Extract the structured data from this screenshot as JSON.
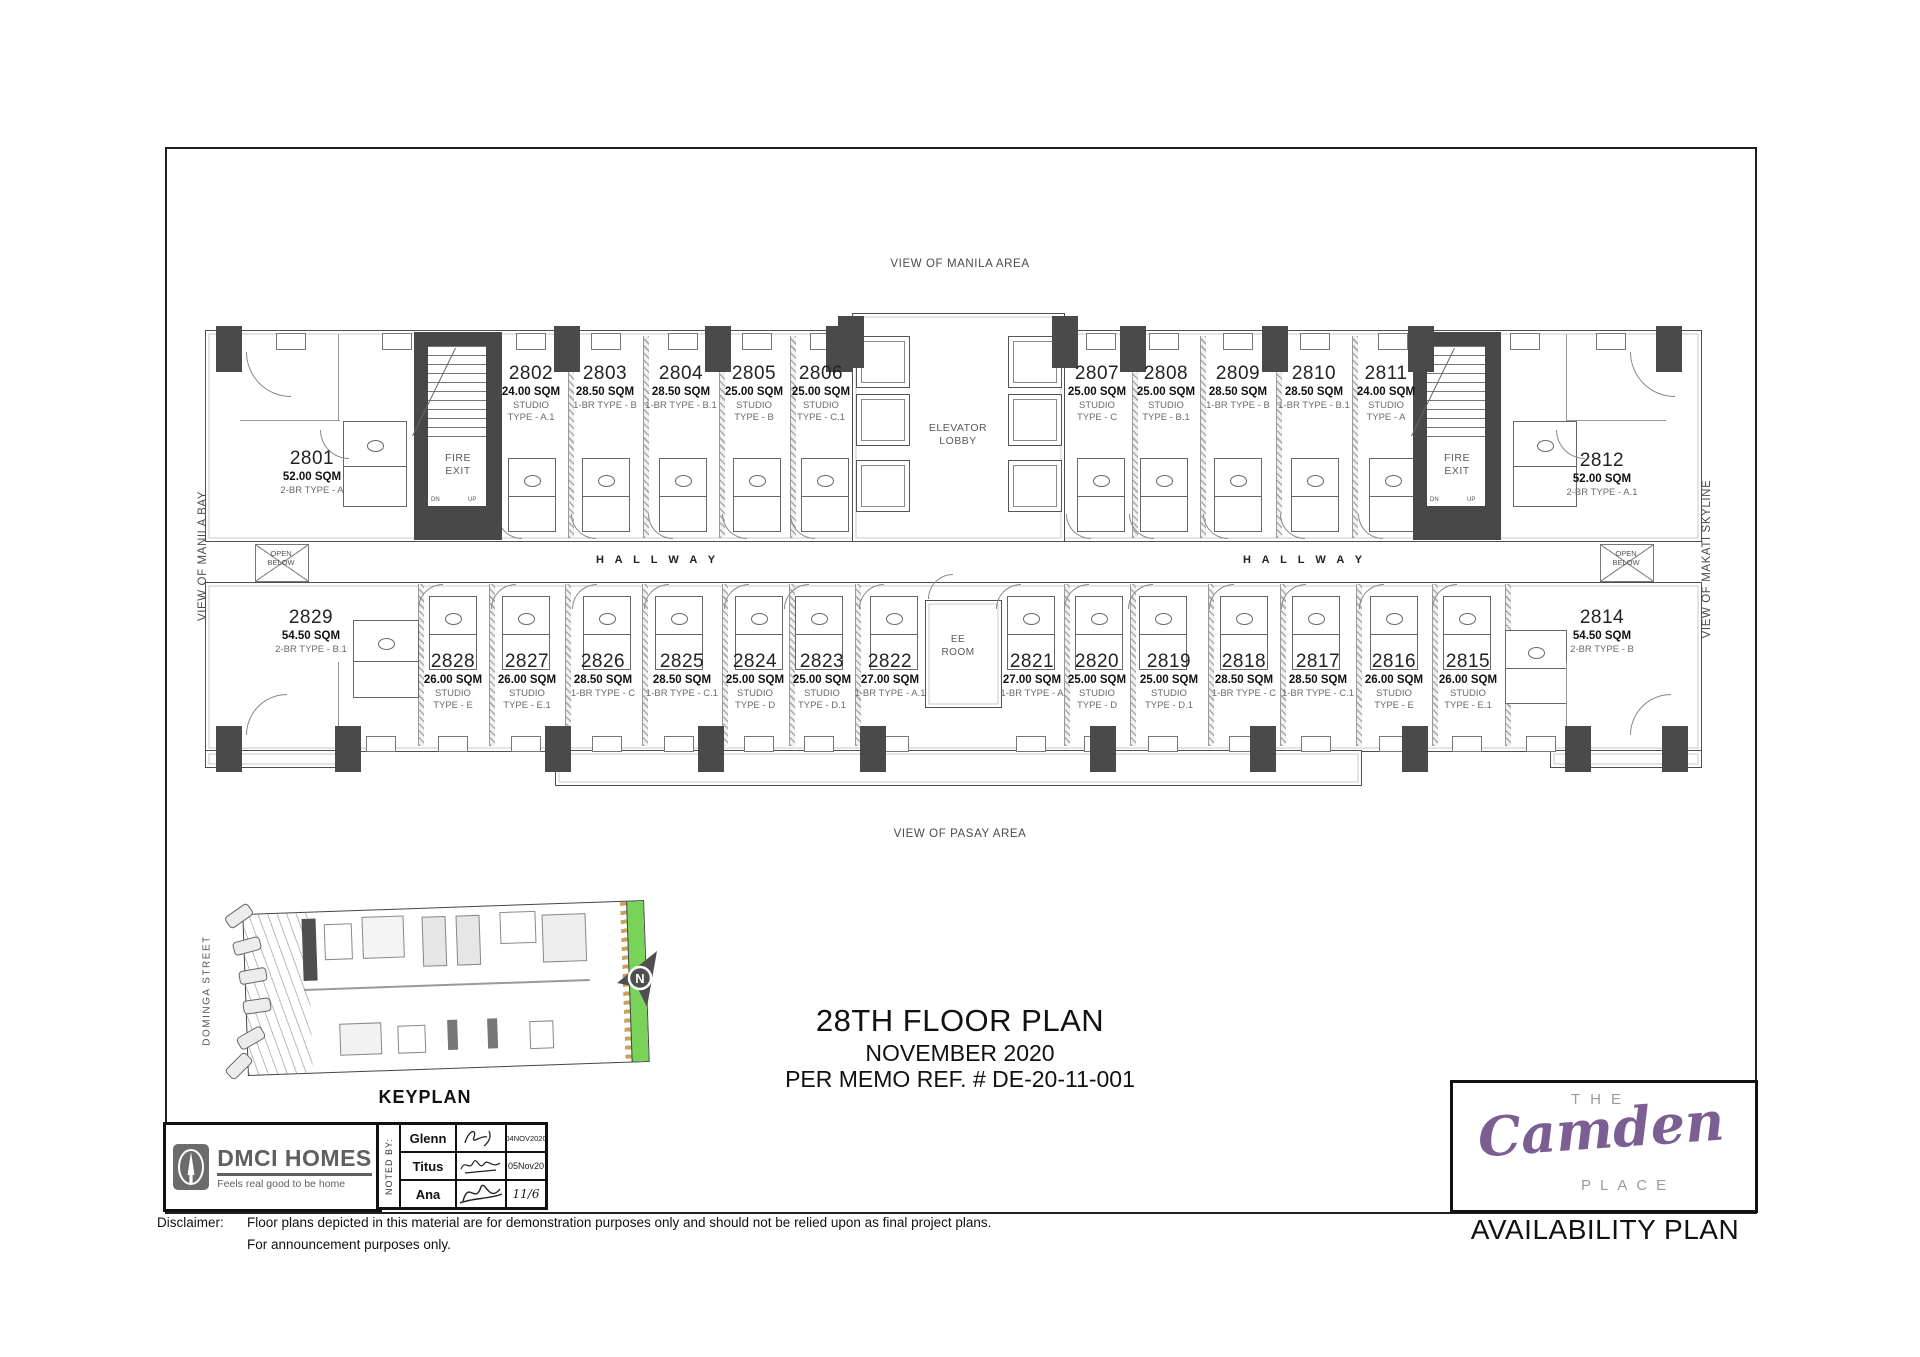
{
  "sheet": {
    "title": "28TH FLOOR PLAN",
    "subtitle": "NOVEMBER 2020",
    "memo": "PER MEMO REF. # DE-20-11-001",
    "availability": "AVAILABILITY PLAN"
  },
  "views": {
    "top": "VIEW OF MANILA AREA",
    "bottom": "VIEW OF PASAY AREA",
    "left": "VIEW OF MANILA BAY",
    "right": "VIEW OF MAKATI SKYLINE"
  },
  "plan_labels": {
    "elevator_lobby": "ELEVATOR\nLOBBY",
    "ee_room": "EE\nROOM",
    "fire_exit": "FIRE\nEXIT",
    "hallway": "H A L L W A Y",
    "open_below": "OPEN\nBELOW",
    "dn": "DN",
    "up": "UP"
  },
  "units_top": [
    {
      "number": "2801",
      "area": "52.00 SQM",
      "type": "2-BR TYPE - A"
    },
    {
      "number": "2802",
      "area": "24.00 SQM",
      "type": "STUDIO\nTYPE - A.1"
    },
    {
      "number": "2803",
      "area": "28.50 SQM",
      "type": "1-BR TYPE - B"
    },
    {
      "number": "2804",
      "area": "28.50 SQM",
      "type": "1-BR TYPE - B.1"
    },
    {
      "number": "2805",
      "area": "25.00 SQM",
      "type": "STUDIO\nTYPE - B"
    },
    {
      "number": "2806",
      "area": "25.00 SQM",
      "type": "STUDIO\nTYPE - C.1"
    },
    {
      "number": "2807",
      "area": "25.00 SQM",
      "type": "STUDIO\nTYPE - C"
    },
    {
      "number": "2808",
      "area": "25.00 SQM",
      "type": "STUDIO\nTYPE - B.1"
    },
    {
      "number": "2809",
      "area": "28.50 SQM",
      "type": "1-BR TYPE - B"
    },
    {
      "number": "2810",
      "area": "28.50 SQM",
      "type": "1-BR TYPE - B.1"
    },
    {
      "number": "2811",
      "area": "24.00 SQM",
      "type": "STUDIO\nTYPE - A"
    },
    {
      "number": "2812",
      "area": "52.00 SQM",
      "type": "2-BR TYPE - A.1"
    }
  ],
  "units_bottom": [
    {
      "number": "2829",
      "area": "54.50 SQM",
      "type": "2-BR TYPE - B.1"
    },
    {
      "number": "2828",
      "area": "26.00 SQM",
      "type": "STUDIO\nTYPE - E"
    },
    {
      "number": "2827",
      "area": "26.00 SQM",
      "type": "STUDIO\nTYPE - E.1"
    },
    {
      "number": "2826",
      "area": "28.50 SQM",
      "type": "1-BR TYPE - C"
    },
    {
      "number": "2825",
      "area": "28.50 SQM",
      "type": "1-BR TYPE - C.1"
    },
    {
      "number": "2824",
      "area": "25.00 SQM",
      "type": "STUDIO\nTYPE - D"
    },
    {
      "number": "2823",
      "area": "25.00 SQM",
      "type": "STUDIO\nTYPE - D.1"
    },
    {
      "number": "2822",
      "area": "27.00 SQM",
      "type": "1-BR TYPE - A.1"
    },
    {
      "number": "2821",
      "area": "27.00 SQM",
      "type": "1-BR TYPE - A"
    },
    {
      "number": "2820",
      "area": "25.00 SQM",
      "type": "STUDIO\nTYPE - D"
    },
    {
      "number": "2819",
      "area": "25.00 SQM",
      "type": "STUDIO\nTYPE - D.1"
    },
    {
      "number": "2818",
      "area": "28.50 SQM",
      "type": "1-BR TYPE - C"
    },
    {
      "number": "2817",
      "area": "28.50 SQM",
      "type": "1-BR TYPE - C.1"
    },
    {
      "number": "2816",
      "area": "26.00 SQM",
      "type": "STUDIO\nTYPE - E"
    },
    {
      "number": "2815",
      "area": "26.00 SQM",
      "type": "STUDIO\nTYPE - E.1"
    },
    {
      "number": "2814",
      "area": "54.50 SQM",
      "type": "2-BR TYPE - B"
    }
  ],
  "keyplan": {
    "caption": "KEYPLAN",
    "street": "DOMINGA STREET",
    "north": "N"
  },
  "branding": {
    "dmci_name": "DMCI HOMES",
    "dmci_tagline": "Feels real good to be home",
    "the": "THE",
    "camden": "Camden",
    "place": "PLACE"
  },
  "noted_by": {
    "label": "NOTED BY:",
    "rows": [
      {
        "name": "Glenn",
        "date": "04NOV2020"
      },
      {
        "name": "Titus",
        "date": "05Nov20"
      },
      {
        "name": "Ana",
        "date": "11/6"
      }
    ]
  },
  "disclaimer": {
    "label": "Disclaimer:",
    "line1": "Floor plans depicted in this material are for demonstration purposes only and should not be relied upon as final project plans.",
    "line2": "For announcement purposes only."
  },
  "colors": {
    "wall_gray": "#4a4a4a",
    "keyplan_green": "#79d358",
    "camden_purple": "#7b5f93",
    "dmci_gray": "#5f5f5f"
  }
}
